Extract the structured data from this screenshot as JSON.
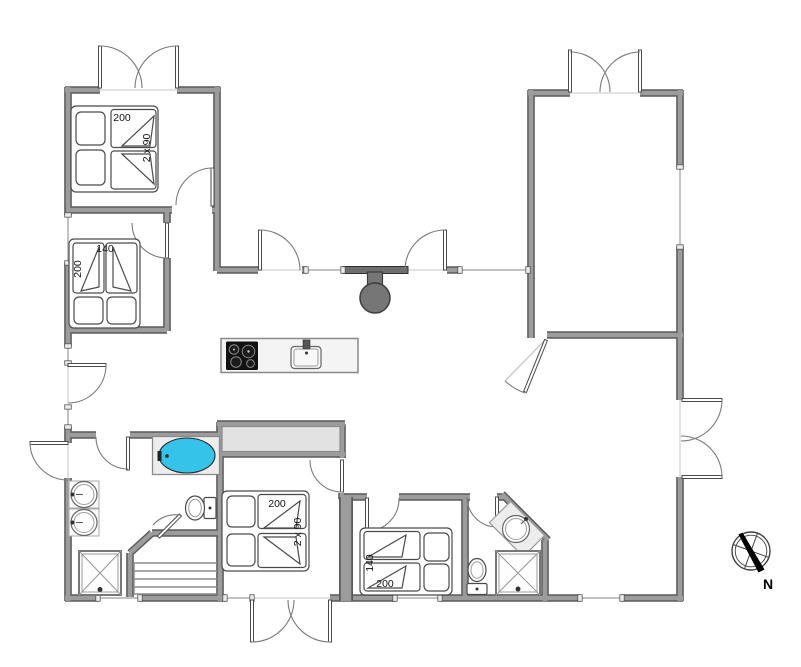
{
  "plan": {
    "labels": {
      "bed1_length": "200",
      "bed1_width": "2 x 90",
      "bed2_width": "140",
      "bed2_length": "200",
      "bed3_length": "200",
      "bed3_width": "2 x 90",
      "bed4_width": "140",
      "bed4_length": "200"
    },
    "compass": {
      "north": "N"
    },
    "colors": {
      "walledge": "#5a5a5a",
      "wallcore": "#9c9c9c",
      "bathtub": "#35c3ea",
      "stove": "#767676",
      "cooktop": "#111111",
      "platform": "#ededed",
      "wardrobe": "#e2e2e2",
      "island": "#f4f4f4"
    }
  }
}
